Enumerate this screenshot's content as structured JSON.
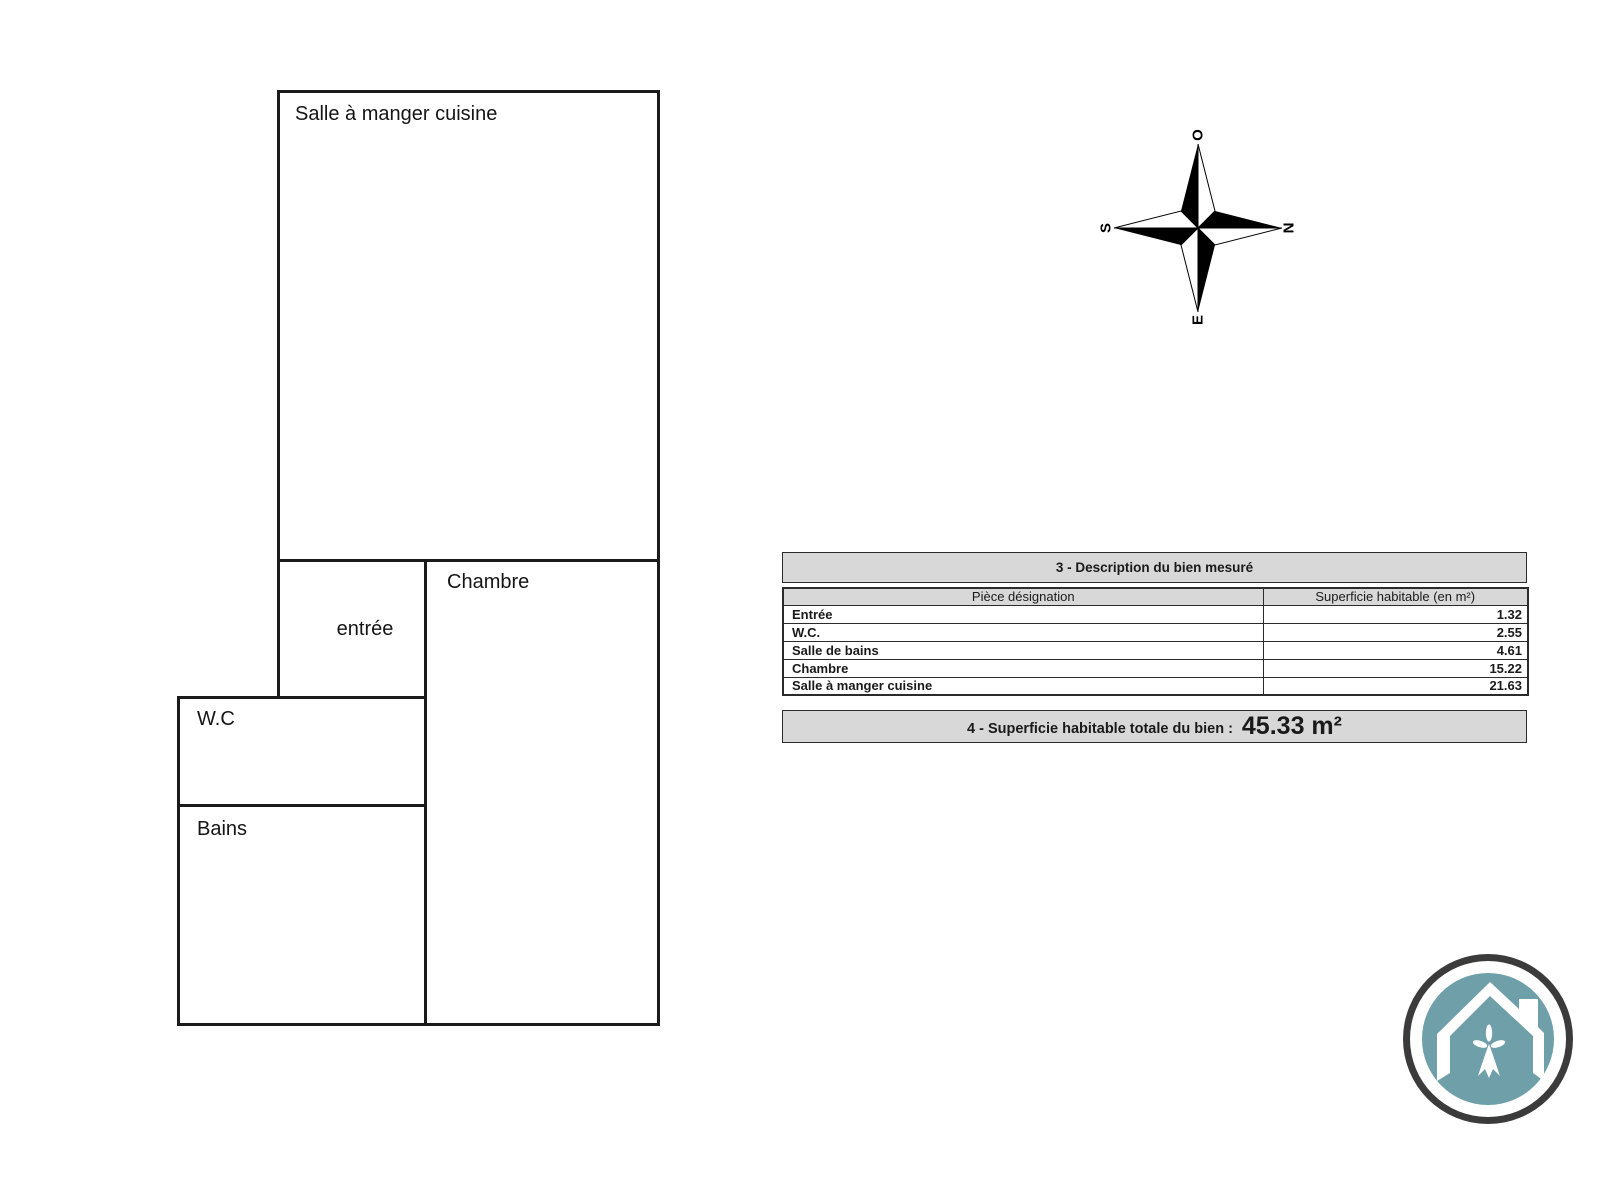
{
  "floor_plan": {
    "rooms": [
      {
        "label": "Salle à manger cuisine"
      },
      {
        "label": "entrée"
      },
      {
        "label": "Chambre"
      },
      {
        "label": "W.C"
      },
      {
        "label": "Bains"
      }
    ]
  },
  "compass": {
    "top": "O",
    "right": "N",
    "bottom": "E",
    "left": "S"
  },
  "table": {
    "title": "3 - Description du bien mesuré",
    "columns": [
      "Pièce désignation",
      "Superficie habitable (en m²)"
    ],
    "rows": [
      {
        "name": "Entrée",
        "area": "1.32"
      },
      {
        "name": "W.C.",
        "area": "2.55"
      },
      {
        "name": "Salle de bains",
        "area": "4.61"
      },
      {
        "name": "Chambre",
        "area": "15.22"
      },
      {
        "name": "Salle à manger cuisine",
        "area": "21.63"
      }
    ]
  },
  "total": {
    "label": "4 - Superficie habitable totale du bien :",
    "value": "45.33 m²"
  },
  "colors": {
    "wall": "#1b1b1b",
    "table_gray": "#d8d8d8",
    "logo_teal": "#6f9fa8",
    "logo_ring": "#3b3b3c"
  }
}
